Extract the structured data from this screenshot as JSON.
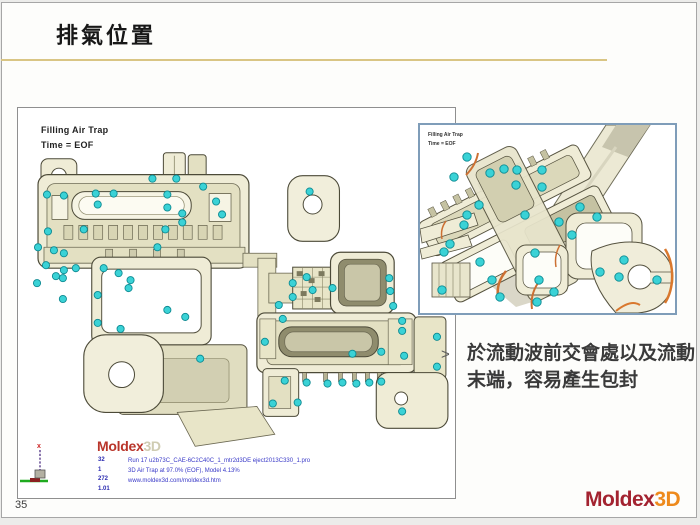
{
  "slide": {
    "title": "排氣位置",
    "page_number": "35",
    "accent_line_color": "#d9c584",
    "footer_logo": {
      "primary": "Moldex",
      "secondary": "3D",
      "primary_color": "#a32330",
      "secondary_color": "#ee8a1c"
    }
  },
  "annotation": {
    "bullet": ">",
    "text": "於流動波前交會處以及流動末端，容易產生包封"
  },
  "main_view": {
    "label_line1": "Filling Air Trap",
    "label_line2": "Time = EOF",
    "logo_primary": "Moldex",
    "logo_secondary": "3D",
    "info_numbers": [
      "32",
      "1",
      "272",
      "1.01"
    ],
    "info_lines": [
      "Run 17 u2b73C_CAE-6C2C40C_1_mtr2d3DE eject2013C330_1.pro",
      "3D Air Trap at 97.0% (EOF), Model 4.13%",
      "www.moldex3d.com/moldex3d.htm"
    ],
    "air_trap_color": "#3ad2d6",
    "air_trap_stroke": "#0d8a92",
    "air_trap_points": [
      [
        29,
        87
      ],
      [
        46,
        88
      ],
      [
        78,
        86
      ],
      [
        96,
        86
      ],
      [
        135,
        71
      ],
      [
        159,
        71
      ],
      [
        150,
        87
      ],
      [
        80,
        97
      ],
      [
        150,
        100
      ],
      [
        165,
        106
      ],
      [
        186,
        79
      ],
      [
        199,
        94
      ],
      [
        205,
        107
      ],
      [
        30,
        124
      ],
      [
        66,
        122
      ],
      [
        148,
        122
      ],
      [
        165,
        115
      ],
      [
        20,
        140
      ],
      [
        36,
        143
      ],
      [
        46,
        146
      ],
      [
        140,
        140
      ],
      [
        28,
        158
      ],
      [
        38,
        169
      ],
      [
        19,
        176
      ],
      [
        45,
        192
      ],
      [
        80,
        188
      ],
      [
        46,
        163
      ],
      [
        58,
        161
      ],
      [
        86,
        161
      ],
      [
        101,
        166
      ],
      [
        113,
        173
      ],
      [
        111,
        181
      ],
      [
        45,
        171
      ],
      [
        80,
        216
      ],
      [
        103,
        222
      ],
      [
        150,
        203
      ],
      [
        168,
        210
      ],
      [
        183,
        252
      ],
      [
        276,
        176
      ],
      [
        290,
        170
      ],
      [
        276,
        190
      ],
      [
        262,
        198
      ],
      [
        296,
        183
      ],
      [
        293,
        84
      ],
      [
        316,
        181
      ],
      [
        373,
        171
      ],
      [
        374,
        184
      ],
      [
        377,
        199
      ],
      [
        386,
        214
      ],
      [
        386,
        224
      ],
      [
        388,
        249
      ],
      [
        266,
        212
      ],
      [
        268,
        274
      ],
      [
        336,
        247
      ],
      [
        365,
        245
      ],
      [
        290,
        276
      ],
      [
        311,
        277
      ],
      [
        326,
        276
      ],
      [
        340,
        277
      ],
      [
        353,
        276
      ],
      [
        365,
        275
      ],
      [
        281,
        296
      ],
      [
        386,
        305
      ],
      [
        256,
        297
      ],
      [
        421,
        230
      ],
      [
        421,
        260
      ],
      [
        248,
        235
      ]
    ]
  },
  "inset_view": {
    "label_line1": "Filling Air Trap",
    "label_line2": "Time = EOF",
    "air_trap_color": "#3ad2d6",
    "air_trap_stroke": "#0d8a92",
    "flow_mark_color": "#cc7033",
    "air_trap_points": [
      [
        47,
        32
      ],
      [
        84,
        44
      ],
      [
        97,
        45
      ],
      [
        122,
        45
      ],
      [
        34,
        52
      ],
      [
        122,
        62
      ],
      [
        59,
        80
      ],
      [
        47,
        90
      ],
      [
        44,
        100
      ],
      [
        30,
        119
      ],
      [
        24,
        127
      ],
      [
        60,
        137
      ],
      [
        72,
        155
      ],
      [
        80,
        172
      ],
      [
        22,
        165
      ],
      [
        115,
        128
      ],
      [
        119,
        155
      ],
      [
        134,
        167
      ],
      [
        117,
        177
      ],
      [
        139,
        97
      ],
      [
        152,
        110
      ],
      [
        160,
        82
      ],
      [
        177,
        92
      ],
      [
        180,
        147
      ],
      [
        199,
        152
      ],
      [
        237,
        155
      ],
      [
        204,
        135
      ],
      [
        96,
        60
      ],
      [
        70,
        48
      ],
      [
        105,
        90
      ]
    ]
  }
}
